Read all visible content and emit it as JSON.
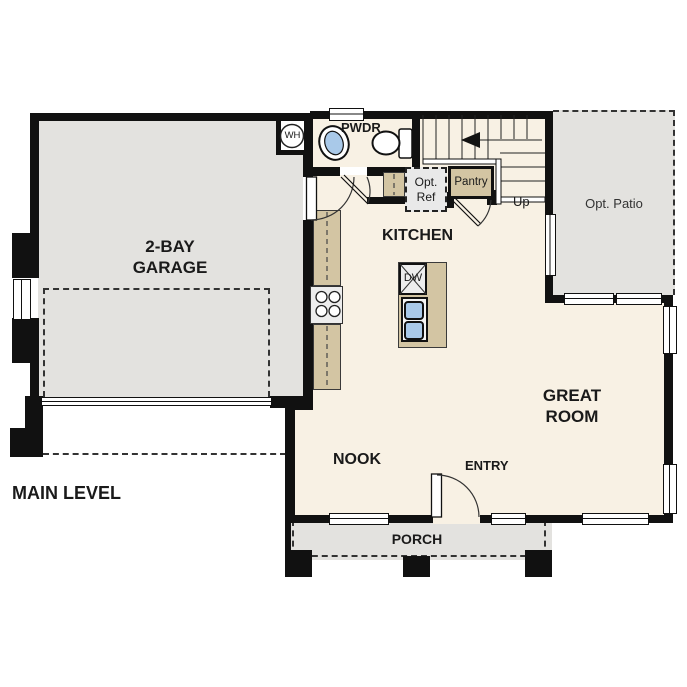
{
  "plan": {
    "level_title": "MAIN LEVEL",
    "rooms": {
      "garage": "2-BAY\nGARAGE",
      "kitchen": "KITCHEN",
      "great_room": "GREAT\nROOM",
      "nook": "NOOK",
      "entry": "ENTRY",
      "porch": "PORCH",
      "powder_room": "PWDR",
      "opt_patio": "Opt. Patio"
    },
    "fixtures": {
      "water_heater": "WH",
      "opt_refrigerator": "Opt.\nRef",
      "pantry": "Pantry",
      "dishwasher": "DW",
      "stairs_direction": "Up"
    },
    "colors": {
      "walls": "#111111",
      "interior_floor": "#f8f1e4",
      "garage_floor": "#e3e2df",
      "patio_floor": "#e3e2df",
      "porch_floor": "#e3e2df",
      "counters": "#d3c5a3",
      "plumbing_blue": "#a9c9e9",
      "appliance_gray": "#ededed",
      "label_text": "#1a1a1a"
    }
  }
}
